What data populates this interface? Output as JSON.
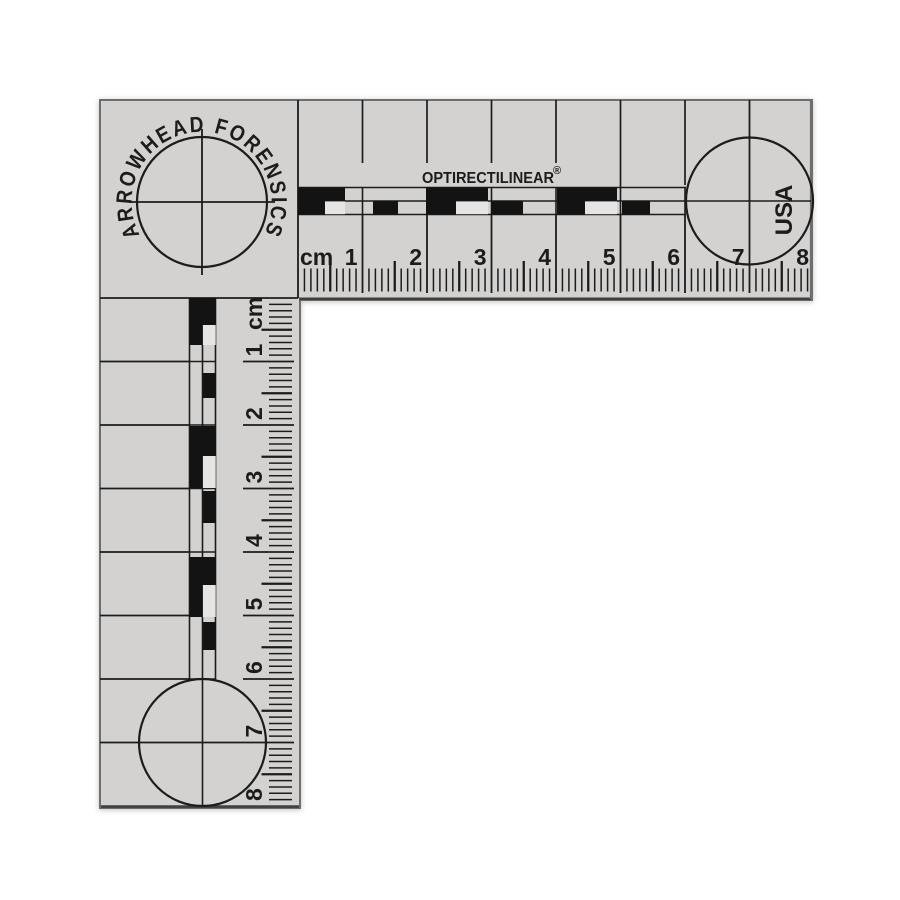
{
  "brand": {
    "arc_text": "ARROWHEAD FORENSICS",
    "product_name": "OPTIRECTILINEAR",
    "registered_mark": "®",
    "country": "USA"
  },
  "scale": {
    "unit": "cm",
    "horizontal_numbers": [
      "1",
      "2",
      "3",
      "4",
      "5",
      "6",
      "7",
      "8"
    ],
    "vertical_numbers": [
      "1",
      "2",
      "3",
      "4",
      "5",
      "6",
      "7",
      "8"
    ]
  },
  "colors": {
    "background": "#ffffff",
    "body": "#d3d2d0",
    "ink": "#1c1c1c",
    "bar_black": "#131313",
    "notch_white": "#e6e5e3",
    "edge_dark": "#3f3f3f",
    "edge_mid": "#6e6e6e"
  }
}
